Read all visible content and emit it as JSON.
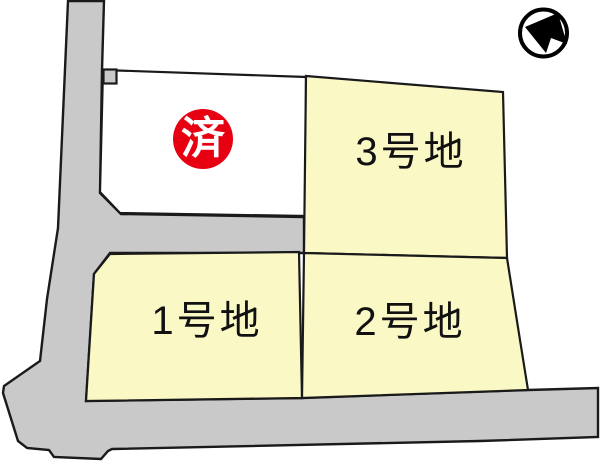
{
  "plots": {
    "lot1": {
      "label": "1号地"
    },
    "lot2": {
      "label": "2号地"
    },
    "lot3": {
      "label": "3号地"
    },
    "sold": {
      "badge": "済"
    }
  },
  "colors": {
    "background": "#FFFFFF",
    "road_gray": "#C9C9C9",
    "lot_yellow": "#FAF8C5",
    "sold_lot_white": "#FFFFFF",
    "outline_black": "#1A1A1A",
    "sold_red": "#E60012",
    "sold_badge_text": "#FFFFFF",
    "label_text": "#111111",
    "compass_black": "#000000"
  }
}
